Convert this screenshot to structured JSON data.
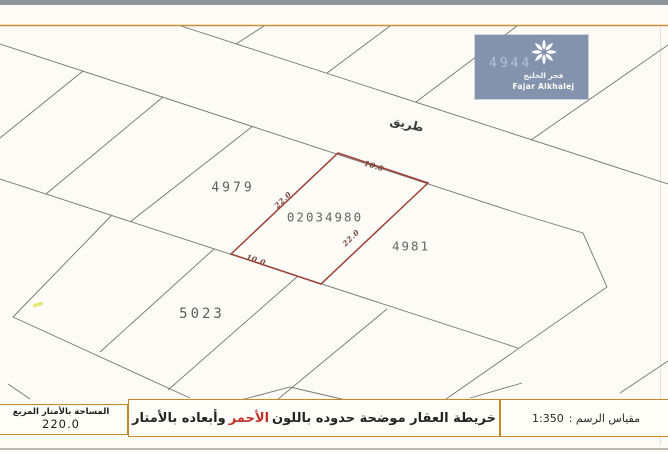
{
  "colors": {
    "accent_orange": "#c8882a",
    "plot_red": "#9c4038",
    "highlight_red": "#c03028",
    "logo_bg": "#8392ad"
  },
  "logo": {
    "number": "4944",
    "name_arabic": "فجر الخليج",
    "name_english": "Fajar Alkhalej",
    "icon": "starburst-flower-icon"
  },
  "map": {
    "road_label": "طريق",
    "parcels": [
      {
        "id": "4979"
      },
      {
        "id": "02034980"
      },
      {
        "id": "4981"
      },
      {
        "id": "5023"
      }
    ],
    "dimensions": [
      {
        "edge": "top",
        "value": "10.0"
      },
      {
        "edge": "left",
        "value": "22.0"
      },
      {
        "edge": "right",
        "value": "22.0"
      },
      {
        "edge": "bottom",
        "value": "10.0"
      }
    ]
  },
  "footer": {
    "area_label": "المساحة بالأمتار المربع",
    "area_value": "220.0",
    "note_prefix": "خريطة العقار موضحة حدوده باللون",
    "note_highlight": "الأحمر",
    "note_suffix": "وأبعاده بالأمتار",
    "scale_label": "مقياس الرسم :",
    "scale_value": "1:350"
  }
}
